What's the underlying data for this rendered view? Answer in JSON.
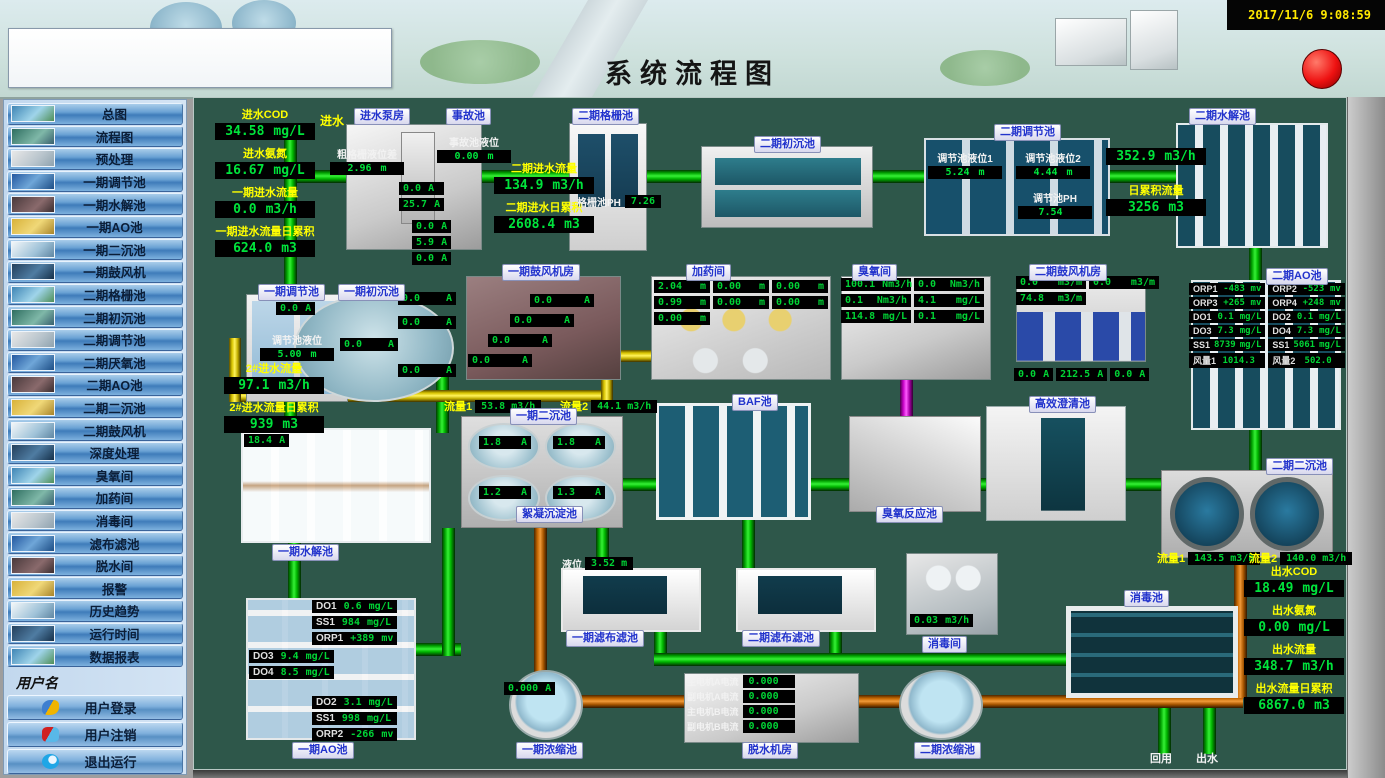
{
  "header": {
    "title": "系统流程图",
    "timestamp": "2017/11/6 9:08:59"
  },
  "sidebar": {
    "items": [
      "总图",
      "流程图",
      "预处理",
      "一期调节池",
      "一期水解池",
      "一期AO池",
      "一期二沉池",
      "一期鼓风机",
      "二期格栅池",
      "二期初沉池",
      "二期调节池",
      "二期厌氧池",
      "二期AO池",
      "二期二沉池",
      "二期鼓风机",
      "深度处理",
      "臭氧间",
      "加药间",
      "消毒间",
      "滤布滤池",
      "脱水间",
      "报警",
      "历史趋势",
      "运行时间",
      "数据报表"
    ],
    "username_label": "用户名",
    "user_buttons": [
      {
        "label": "用户登录",
        "icon": "user-login-icon"
      },
      {
        "label": "用户注销",
        "icon": "user-logout-icon"
      },
      {
        "label": "退出运行",
        "icon": "exit-run-icon"
      }
    ],
    "company": "山东新日电气设备有限公司"
  },
  "colors": {
    "accent_green": "#00e43c",
    "label_yellow": "#ffff00",
    "chip_blue": "#2233cc",
    "pipe_green": "#00cc00",
    "pipe_orange": "#cc6a00",
    "pipe_yellow": "#ffe800",
    "pipe_magenta": "#ff00ff",
    "alarm_red": "#ee1111"
  },
  "inlet": {
    "flow_label": "进水",
    "metrics": [
      {
        "l": "进水COD",
        "v": "34.58",
        "u": "mg/L"
      },
      {
        "l": "进水氨氮",
        "v": "16.67",
        "u": "mg/L"
      },
      {
        "l": "一期进水流量",
        "v": "0.0",
        "u": "m3/h"
      },
      {
        "l": "一期进水流量日累积",
        "v": "624.0",
        "u": "m3"
      }
    ]
  },
  "pump_house": {
    "label": "进水泵房",
    "level": {
      "l": "粗格栅液位差",
      "v": "2.96",
      "u": "m"
    },
    "currents": [
      {
        "v": "0.0",
        "u": "A"
      },
      {
        "v": "25.7",
        "u": "A"
      }
    ],
    "currents2": [
      {
        "v": "0.0",
        "u": "A"
      },
      {
        "v": "5.9",
        "u": "A"
      },
      {
        "v": "0.0",
        "u": "A"
      }
    ]
  },
  "accident_pool": {
    "label": "事故池",
    "metrics": [
      {
        "l": "事故池液位",
        "v": "0.00",
        "u": "m"
      }
    ]
  },
  "phase2_inflow": {
    "metrics": [
      {
        "l": "二期进水流量",
        "v": "134.9",
        "u": "m3/h"
      },
      {
        "l": "二期进水日累积",
        "v": "2608.4",
        "u": "m3"
      }
    ]
  },
  "phase2_screen": {
    "label": "二期格栅池",
    "ph": {
      "l": "格栅池PH",
      "v": "7.26"
    }
  },
  "phase2_primary": {
    "label": "二期初沉池"
  },
  "phase2_regulating": {
    "label": "二期调节池",
    "metrics": [
      {
        "l": "调节池液位1",
        "v": "5.24",
        "u": "m"
      },
      {
        "l": "调节池液位2",
        "v": "4.44",
        "u": "m"
      },
      {
        "l": "调节池PH",
        "v": "7.54",
        "u": ""
      }
    ]
  },
  "phase2_hydrolysis": {
    "label": "二期水解池",
    "flow": {
      "v": "352.9",
      "u": "m3/h"
    },
    "daily": {
      "l": "日累积流量",
      "v": "3256",
      "u": "m3"
    }
  },
  "phase1_regulating": {
    "label": "一期调节池",
    "current": {
      "v": "0.0",
      "u": "A"
    },
    "level": {
      "l": "调节池液位",
      "v": "5.00",
      "u": "m"
    }
  },
  "phase1_primary": {
    "label": "一期初沉池",
    "currents": [
      {
        "v": "0.0",
        "u": "A"
      },
      {
        "v": "0.0",
        "u": "A"
      },
      {
        "v": "0.0",
        "u": "A"
      },
      {
        "v": "0.0",
        "u": "A"
      }
    ]
  },
  "phase1_blower": {
    "label": "一期鼓风机房",
    "currents": [
      {
        "v": "0.0",
        "u": "A"
      },
      {
        "v": "0.0",
        "u": "A"
      },
      {
        "v": "0.0",
        "u": "A"
      },
      {
        "v": "0.0",
        "u": "A"
      }
    ]
  },
  "dosing_room": {
    "label": "加药间",
    "levels": [
      {
        "v": "2.04",
        "u": "m"
      },
      {
        "v": "0.00",
        "u": "m"
      },
      {
        "v": "0.00",
        "u": "m"
      },
      {
        "v": "0.99",
        "u": "m"
      },
      {
        "v": "0.00",
        "u": "m"
      },
      {
        "v": "0.00",
        "u": "m"
      },
      {
        "v": "0.00",
        "u": "m"
      }
    ]
  },
  "ozone_room": {
    "label": "臭氧间",
    "readouts": [
      {
        "v": "100.1",
        "u": "Nm3/h"
      },
      {
        "v": "0.0",
        "u": "Nm3/h"
      },
      {
        "v": "0.1",
        "u": "Nm3/h"
      },
      {
        "v": "4.1",
        "u": "mg/L"
      },
      {
        "v": "114.8",
        "u": "mg/L"
      },
      {
        "v": "0.1",
        "u": "mg/L"
      }
    ]
  },
  "phase2_blower": {
    "label": "二期鼓风机房",
    "flows": [
      {
        "v": "0.0",
        "u": "m3/m"
      },
      {
        "v": "0.0",
        "u": "m3/m"
      },
      {
        "v": "74.8",
        "u": "m3/m"
      }
    ],
    "currents": [
      {
        "v": "0.0",
        "u": "A"
      },
      {
        "v": "212.5",
        "u": "A"
      },
      {
        "v": "0.0",
        "u": "A"
      }
    ]
  },
  "phase2_ao": {
    "label": "二期AO池",
    "readouts": [
      {
        "l": "ORP1",
        "v": "-483",
        "u": "mv"
      },
      {
        "l": "ORP2",
        "v": "-523",
        "u": "mv"
      },
      {
        "l": "ORP3",
        "v": "+265",
        "u": "mv"
      },
      {
        "l": "ORP4",
        "v": "+248",
        "u": "mv"
      },
      {
        "l": "DO1",
        "v": "0.1",
        "u": "mg/L"
      },
      {
        "l": "DO2",
        "v": "0.1",
        "u": "mg/L"
      },
      {
        "l": "DO3",
        "v": "7.3",
        "u": "mg/L"
      },
      {
        "l": "DO4",
        "v": "7.3",
        "u": "mg/L"
      },
      {
        "l": "SS1",
        "v": "8739",
        "u": "mg/L"
      },
      {
        "l": "SS1",
        "v": "5061",
        "u": "mg/L"
      },
      {
        "l": "风量1",
        "v": "1014.3",
        "u": ""
      },
      {
        "l": "风量2",
        "v": "502.0",
        "u": ""
      }
    ]
  },
  "phase2_inflow2": {
    "metrics": [
      {
        "l": "2#进水流量",
        "v": "97.1",
        "u": "m3/h"
      },
      {
        "l": "2#进水流量日累积",
        "v": "939",
        "u": "m3"
      }
    ]
  },
  "phase1_hydrolysis": {
    "label": "一期水解池",
    "current": {
      "v": "18.4",
      "u": "A"
    }
  },
  "phase1_secondary": {
    "label": "一期二沉池",
    "flow1": {
      "l": "流量1",
      "v": "53.8",
      "u": "m3/h"
    },
    "flow2": {
      "l": "流量2",
      "v": "44.1",
      "u": "m3/h"
    },
    "currents": [
      {
        "v": "1.8",
        "u": "A"
      },
      {
        "v": "1.8",
        "u": "A"
      },
      {
        "v": "1.2",
        "u": "A"
      },
      {
        "v": "1.3",
        "u": "A"
      }
    ],
    "bottom_label": "絮凝沉淀池"
  },
  "baf": {
    "label": "BAF池"
  },
  "ozone_reaction": {
    "label": "臭氧反应池"
  },
  "clarifier": {
    "label": "高效澄清池"
  },
  "phase2_secondary": {
    "label": "二期二沉池",
    "flow1": {
      "l": "流量1",
      "v": "143.5",
      "u": "m3/h"
    },
    "flow2": {
      "l": "流量2",
      "v": "140.0",
      "u": "m3/h"
    }
  },
  "outlet": {
    "metrics": [
      {
        "l": "出水COD",
        "v": "18.49",
        "u": "mg/L"
      },
      {
        "l": "出水氨氮",
        "v": "0.00",
        "u": "mg/L"
      },
      {
        "l": "出水流量",
        "v": "348.7",
        "u": "m3/h"
      },
      {
        "l": "出水流量日累积",
        "v": "6867.0",
        "u": "m3"
      }
    ],
    "reuse_label": "回用",
    "out_label": "出水"
  },
  "phase1_ao": {
    "label": "一期AO池",
    "group1": [
      {
        "l": "DO1",
        "v": "0.6",
        "u": "mg/L"
      },
      {
        "l": "SS1",
        "v": "984",
        "u": "mg/L"
      },
      {
        "l": "ORP1",
        "v": "+389",
        "u": "mv"
      }
    ],
    "group2": [
      {
        "l": "DO3",
        "v": "9.4",
        "u": "mg/L"
      },
      {
        "l": "DO4",
        "v": "8.5",
        "u": "mg/L"
      }
    ],
    "group3": [
      {
        "l": "DO2",
        "v": "3.1",
        "u": "mg/L"
      },
      {
        "l": "SS1",
        "v": "998",
        "u": "mg/L"
      },
      {
        "l": "ORP2",
        "v": "-266",
        "u": "mv"
      }
    ]
  },
  "filter1": {
    "label": "一期滤布滤池",
    "level": {
      "l": "液位",
      "v": "3.52",
      "u": "m"
    }
  },
  "filter2": {
    "label": "二期滤布滤池"
  },
  "disinfect_room": {
    "label": "消毒间",
    "flow": {
      "v": "0.03",
      "u": "m3/h"
    }
  },
  "disinfect_pool": {
    "label": "消毒池"
  },
  "thickener1": {
    "label": "一期浓缩池",
    "current": {
      "v": "0.000",
      "u": "A"
    }
  },
  "dewatering": {
    "label": "脱水机房",
    "currents": [
      {
        "l": "主电机A电流",
        "v": "0.000"
      },
      {
        "l": "副电机A电流",
        "v": "0.000"
      },
      {
        "l": "主电机B电流",
        "v": "0.000"
      },
      {
        "l": "副电机B电流",
        "v": "0.000"
      }
    ]
  },
  "thickener2": {
    "label": "二期浓缩池"
  }
}
